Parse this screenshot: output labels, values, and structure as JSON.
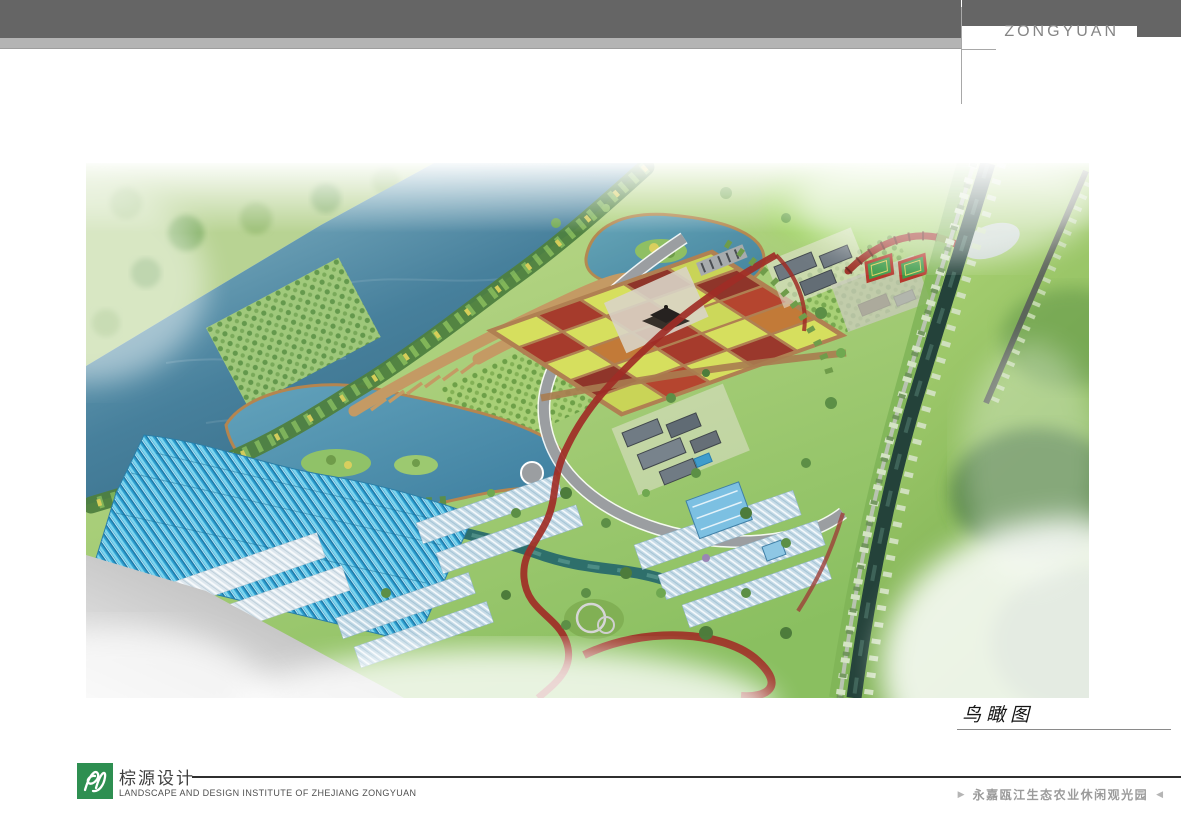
{
  "header": {
    "brand": "ZONGYUAN"
  },
  "figure": {
    "caption": "鸟瞰图"
  },
  "footer": {
    "company_cn": "棕源设计",
    "company_en": "LANDSCAPE AND DESIGN INSTITUTE OF ZHEJIANG ZONGYUAN",
    "project_title": "永嘉瓯江生态农业休闲观光园",
    "marker_left": "▶",
    "marker_right": "◀"
  },
  "colors": {
    "brand_green": "#2e8f51",
    "header_bar_dark": "#656565",
    "header_bar_light": "#b4b4b4",
    "brand_text_gray": "#858585",
    "footer_rule_dark": "#2f2f2f",
    "river_blue": "#47809c",
    "lake_blue": "#4286a6",
    "park_green": "#8abf60",
    "greenhouse_cyan": "#3fbde4",
    "red_trail": "#a02d26",
    "canal_dark": "#24423a",
    "road_gray": "#9b9ea1",
    "boardwalk_tan": "#c49a64"
  }
}
